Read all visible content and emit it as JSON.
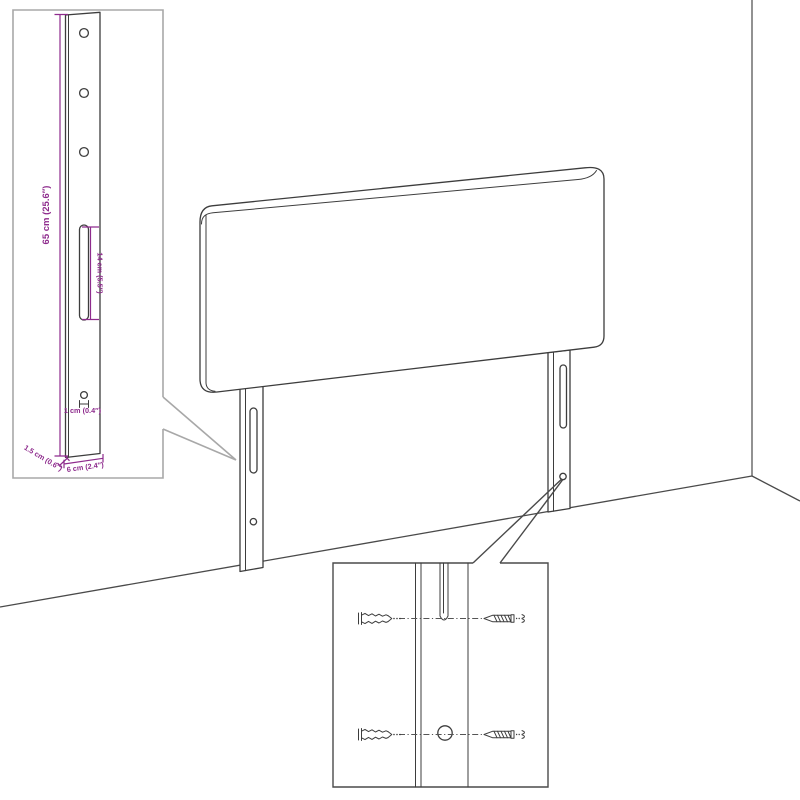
{
  "colors": {
    "background": "#FFFFFF",
    "dimension_accent": "#8E2B8D",
    "drawing_line": "#3D3D3D",
    "leg_inset_border": "#A8A8A8",
    "hardware_inset_border": "#4A4A4A",
    "wall_line": "#7F7F7F",
    "floor_line": "#4A4A4A"
  },
  "leg_detail_inset": {
    "labels": {
      "leg_height": "65 cm (25.6″)",
      "slot_length": "14 cm (5.5″)",
      "hole_diameter": "1 cm (0.4″)",
      "leg_thickness": "1.5 cm (0.6″)",
      "leg_width": "6 cm (2.4″)"
    },
    "features": {
      "screw_holes": 3,
      "slots": 1,
      "small_holes": 1
    }
  },
  "hardware_detail_inset": {
    "icons": [
      "wall-plug-icon",
      "screw-icon"
    ],
    "wall_plugs": 2,
    "screws": 2
  },
  "main_view": {
    "parts": [
      "headboard-panel",
      "left-leg",
      "right-leg",
      "wall-corner",
      "floor-line"
    ],
    "leg_slots": 2,
    "leg_holes": 2
  }
}
